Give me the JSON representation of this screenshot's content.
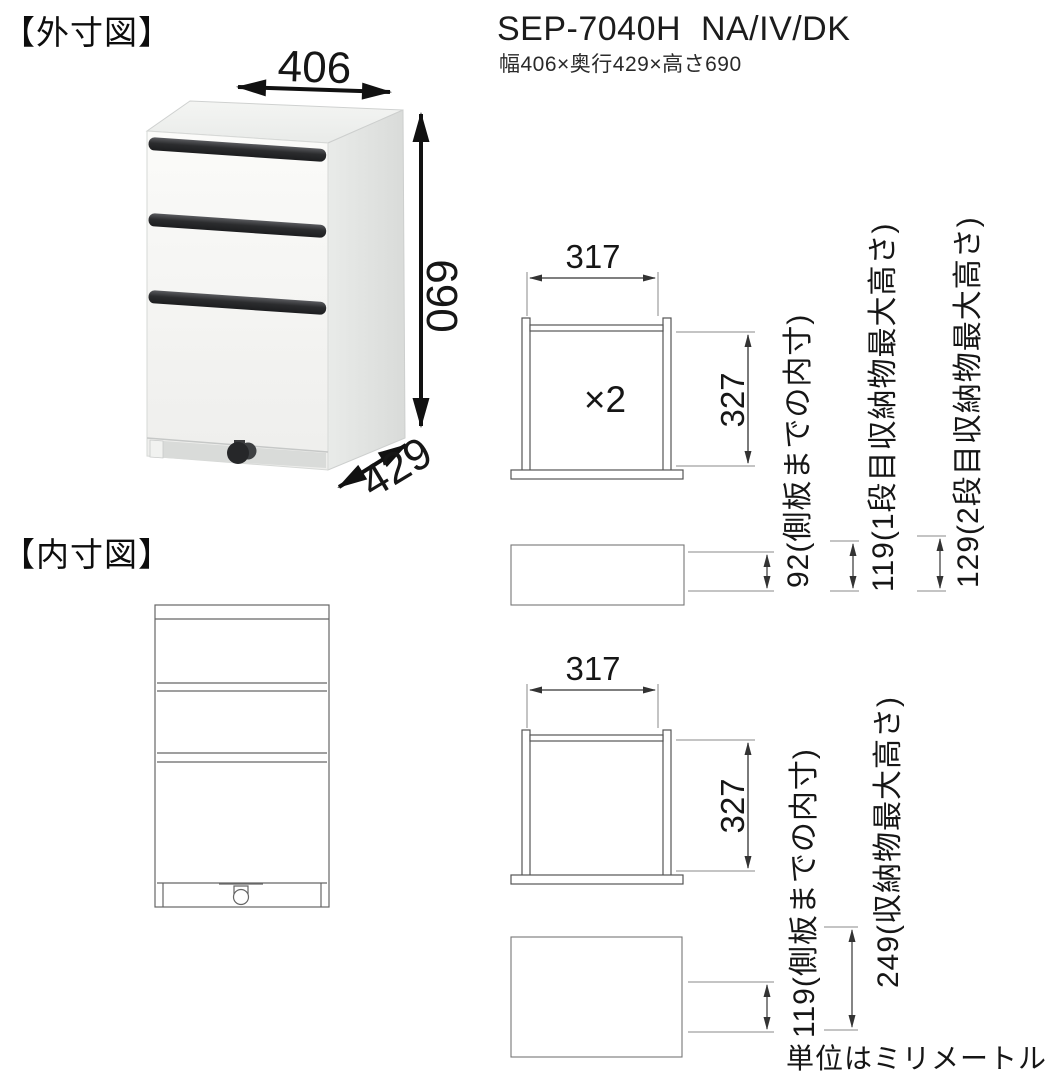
{
  "headings": {
    "outer": "【外寸図】",
    "inner": "【内寸図】"
  },
  "product": {
    "model": "SEP-7040H  NA/IV/DK",
    "dimensions_summary": "幅406×奥行429×高さ690"
  },
  "outer_diagram": {
    "width_mm": "406",
    "height_mm": "690",
    "depth_mm": "429"
  },
  "inner_top_diagram": {
    "width_mm": "317",
    "depth_mm": "327",
    "quantity_note": "×2",
    "side_panel_inner": "92(側板までの内寸)",
    "tier1_max_height": "119(1段目収納物最大高さ)",
    "tier2_max_height": "129(2段目収納物最大高さ)"
  },
  "inner_bottom_diagram": {
    "width_mm": "317",
    "depth_mm": "327",
    "side_panel_inner": "119(側板までの内寸)",
    "max_height": "249(収納物最大高さ)"
  },
  "footnote": {
    "units": "単位はミリメートル"
  }
}
